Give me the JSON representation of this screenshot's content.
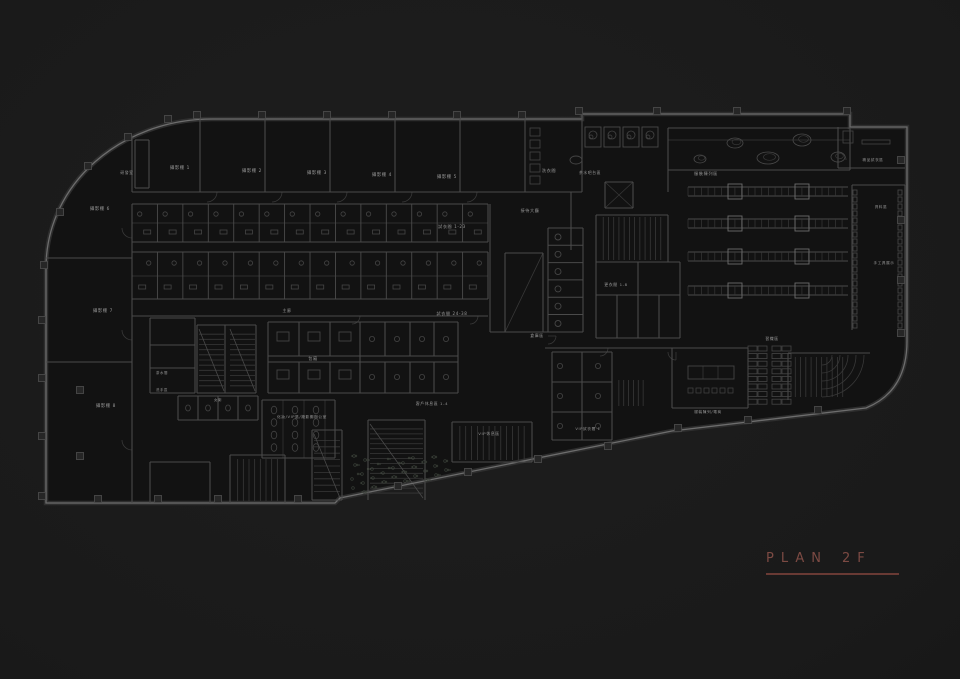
{
  "title": {
    "main": "PLAN",
    "floor": "2F"
  },
  "colors": {
    "background": "#1c1c1c",
    "floor_fill": "#121212",
    "wall_bright": "#6d6d6d",
    "wall_mid": "#4a4a4a",
    "wall_dim": "#383838",
    "wall_underlay": "#2e2e2e",
    "detail": "#454545",
    "column_fill": "#262626",
    "garden": "#3e443c",
    "label_text": "#979797",
    "accent_text": "#7c4a43",
    "accent_rule": "#693a34"
  },
  "floorplan": {
    "drawing_name": "second-floor-plan",
    "labels": [
      {
        "text": "研發室",
        "x": 127,
        "y": 174,
        "fs": 3.8
      },
      {
        "text": "攝影棚 1",
        "x": 180,
        "y": 169,
        "fs": 4.3
      },
      {
        "text": "攝影棚 2",
        "x": 252,
        "y": 172,
        "fs": 4.3
      },
      {
        "text": "攝影棚 3",
        "x": 317,
        "y": 174,
        "fs": 4.3
      },
      {
        "text": "攝影棚 4",
        "x": 382,
        "y": 176,
        "fs": 4.3
      },
      {
        "text": "攝影棚 5",
        "x": 447,
        "y": 178,
        "fs": 4.3
      },
      {
        "text": "洗衣間",
        "x": 549,
        "y": 172,
        "fs": 4.2
      },
      {
        "text": "茶水吧台區",
        "x": 590,
        "y": 174,
        "fs": 3.8
      },
      {
        "text": "服裝陳列區",
        "x": 706,
        "y": 175,
        "fs": 4.2
      },
      {
        "text": "精品試衣區",
        "x": 873,
        "y": 161,
        "fs": 3.6
      },
      {
        "text": "資料區",
        "x": 881,
        "y": 208,
        "fs": 3.6
      },
      {
        "text": "手工具展示",
        "x": 884,
        "y": 264,
        "fs": 3.6
      },
      {
        "text": "攝影棚 6",
        "x": 100,
        "y": 210,
        "fs": 4.3
      },
      {
        "text": "攝影棚 7",
        "x": 103,
        "y": 312,
        "fs": 4.3
      },
      {
        "text": "攝影棚 8",
        "x": 106,
        "y": 407,
        "fs": 4.3
      },
      {
        "text": "試衣間 1-23",
        "x": 452,
        "y": 228,
        "fs": 4.1
      },
      {
        "text": "試衣間 24-38",
        "x": 452,
        "y": 315,
        "fs": 4.1
      },
      {
        "text": "接待大廳",
        "x": 530,
        "y": 212,
        "fs": 4.1
      },
      {
        "text": "主廊",
        "x": 287,
        "y": 312,
        "fs": 3.9
      },
      {
        "text": "包廂",
        "x": 313,
        "y": 360,
        "fs": 4.1
      },
      {
        "text": "倉庫區",
        "x": 537,
        "y": 337,
        "fs": 3.9
      },
      {
        "text": "更衣間 1-8",
        "x": 616,
        "y": 286,
        "fs": 3.9
      },
      {
        "text": "茶水間",
        "x": 162,
        "y": 374,
        "fs": 3.4
      },
      {
        "text": "洗手區",
        "x": 162,
        "y": 391,
        "fs": 3.4
      },
      {
        "text": "女廁",
        "x": 218,
        "y": 401,
        "fs": 3.4
      },
      {
        "text": "化妝/VIP區/攝影棚辦公室",
        "x": 302,
        "y": 418,
        "fs": 3.7
      },
      {
        "text": "客戶休息區 1-4",
        "x": 432,
        "y": 405,
        "fs": 3.9
      },
      {
        "text": "VIP休息區",
        "x": 489,
        "y": 435,
        "fs": 3.9
      },
      {
        "text": "VIP試衣間 1",
        "x": 588,
        "y": 430,
        "fs": 3.7
      },
      {
        "text": "服裝陳列/電商",
        "x": 708,
        "y": 413,
        "fs": 3.7
      },
      {
        "text": "習織區",
        "x": 772,
        "y": 340,
        "fs": 3.9
      }
    ]
  }
}
